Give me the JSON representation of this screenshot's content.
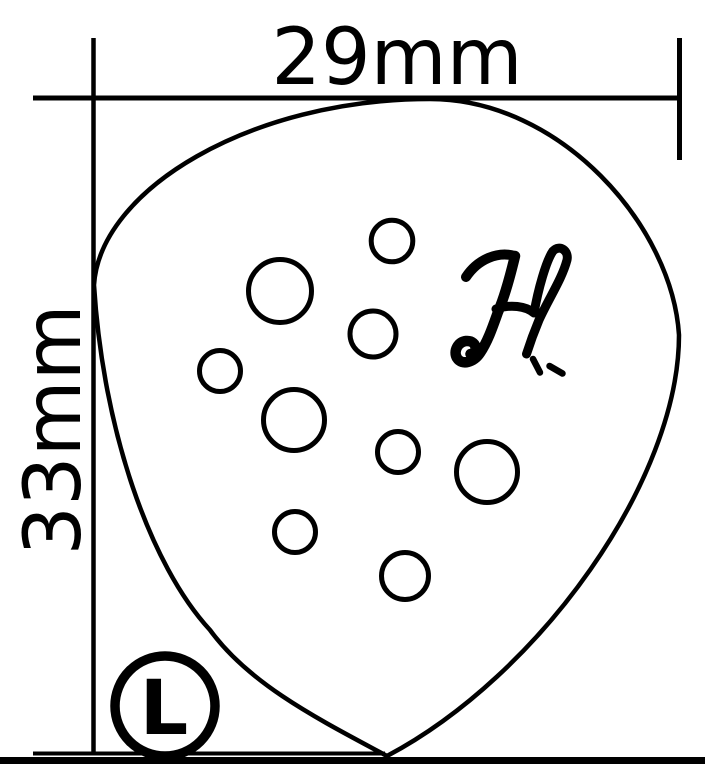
{
  "colors": {
    "ink": "#000000",
    "background": "#ffffff"
  },
  "dimensions": {
    "width_label": "29mm",
    "height_label": "33mm"
  },
  "pick": {
    "holes_count": 9
  },
  "logo": {
    "letter": "H"
  },
  "size_badge": {
    "letter": "L"
  }
}
